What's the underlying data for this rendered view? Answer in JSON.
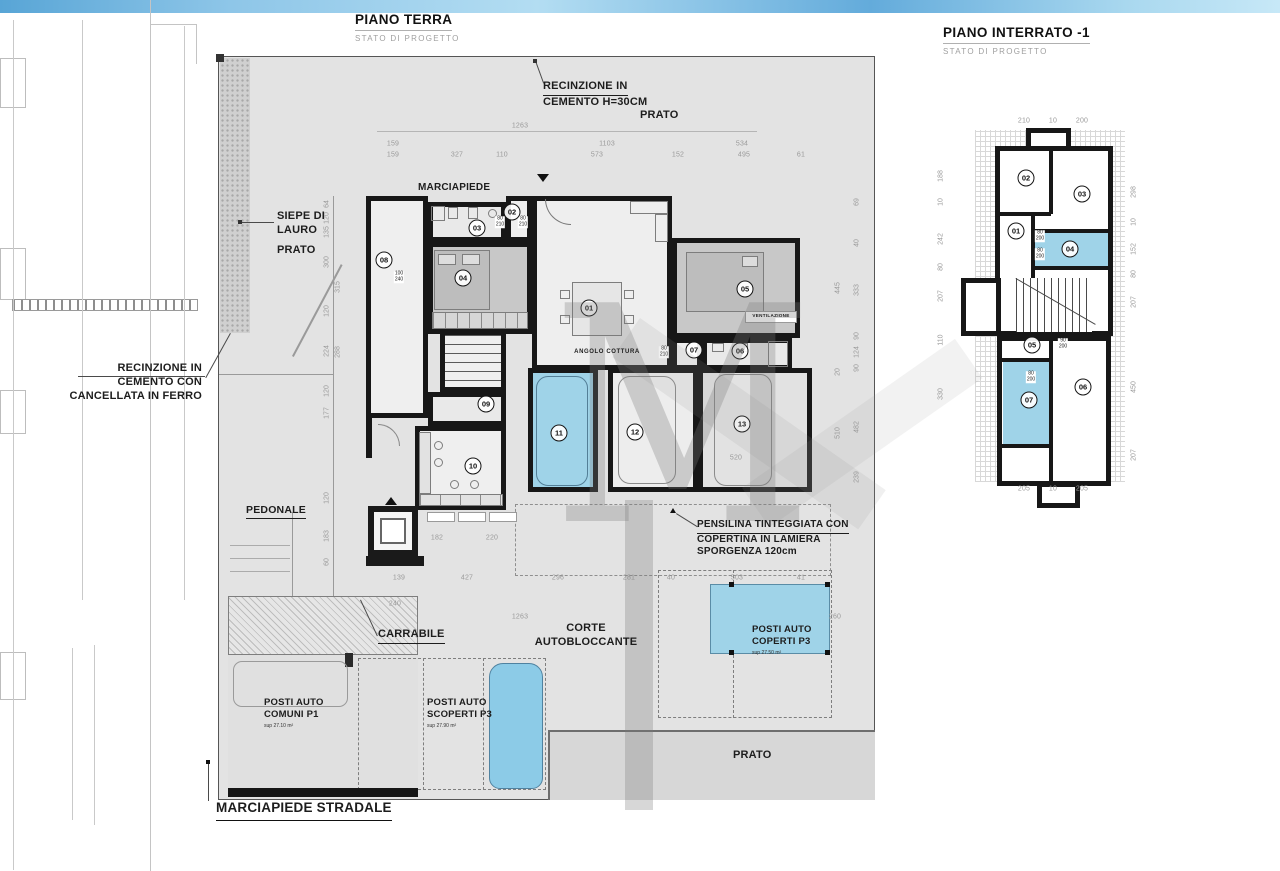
{
  "titles": {
    "left": {
      "title": "PIANO TERRA",
      "subtitle": "STATO DI PROGETTO"
    },
    "right": {
      "title": "PIANO INTERRATO -1",
      "subtitle": "STATO DI PROGETTO"
    }
  },
  "labels": {
    "recinzione_top": {
      "l1": "RECINZIONE IN",
      "l2": "CEMENTO H=30CM"
    },
    "prato_top": "PRATO",
    "marciapiede": "MARCIAPIEDE",
    "siepe": {
      "l1": "SIEPE DI",
      "l2": "LAURO"
    },
    "prato_left": "PRATO",
    "recinzione_left": {
      "l1": "RECINZIONE IN",
      "l2": "CEMENTO CON",
      "l3": "CANCELLATA IN FERRO"
    },
    "pedonale": "PEDONALE",
    "carrabile": "CARRABILE",
    "corte": {
      "l1": "CORTE",
      "l2": "AUTOBLOCCANTE"
    },
    "angolo_cottura": "ANGOLO COTTURA",
    "ventilazione": "VENTILAZIONE",
    "pensilina": {
      "l1": "PENSILINA TINTEGGIATA CON",
      "l2": "COPERTINA IN LAMIERA",
      "l3": "SPORGENZA 120cm"
    },
    "posti_comuni": {
      "l1": "POSTI AUTO",
      "l2": "COMUNI P1",
      "sup": "sup 27.10 m²"
    },
    "posti_scoperti": {
      "l1": "POSTI AUTO",
      "l2": "SCOPERTI P3",
      "sup": "sup 27.90 m²"
    },
    "posti_coperti": {
      "l1": "POSTI AUTO",
      "l2": "COPERTI P3",
      "sup": "sup 27.50 m²"
    },
    "marciapiede_stradale": "MARCIAPIEDE STRADALE",
    "prato_bottom": "PRATO"
  },
  "ground_rooms": [
    "01",
    "02",
    "03",
    "04",
    "05",
    "06",
    "07",
    "08",
    "09",
    "10",
    "11",
    "12",
    "13"
  ],
  "basement_rooms": [
    "01",
    "02",
    "03",
    "04",
    "05",
    "06",
    "07"
  ],
  "dims": {
    "top_total": "1263",
    "top_row2": [
      "159",
      "1103",
      "534"
    ],
    "top_row3": [
      "159",
      "327",
      "110",
      "573",
      "152",
      "495",
      "61"
    ],
    "bottom_row": [
      "139",
      "427",
      "296",
      "281",
      "40",
      "503",
      "41"
    ],
    "bottom_240": "240",
    "bottom_total": "1263",
    "mid_182": "182",
    "mid_220": "220",
    "room13_520": "520",
    "right_260": "260",
    "right_col": [
      "69",
      "40",
      "333",
      "445",
      "90",
      "124",
      "90",
      "20",
      "510",
      "482",
      "239"
    ],
    "left_col": [
      "64",
      "120",
      "135",
      "300",
      "315",
      "120",
      "224",
      "288",
      "120",
      "177",
      "120",
      "183",
      "60"
    ],
    "bas_top": [
      "210",
      "10",
      "200"
    ],
    "bas_bottom": [
      "205",
      "10",
      "205"
    ],
    "bas_left": [
      "188",
      "10",
      "242",
      "80",
      "207",
      "110",
      "330"
    ],
    "bas_right": [
      "298",
      "10",
      "152",
      "80",
      "207",
      "450",
      "207"
    ],
    "tags": [
      "100\n240",
      "80\n210",
      "80\n210",
      "80\n210",
      "80\n200",
      "80\n200",
      "90\n200",
      "80\n200"
    ]
  },
  "colors": {
    "accent_blue": "#9fd3e8",
    "car_blue": "#8ccbe7",
    "wall": "#171717",
    "parcel_gray": "#e3e3e3",
    "grass_gray": "#d7d7d7"
  }
}
